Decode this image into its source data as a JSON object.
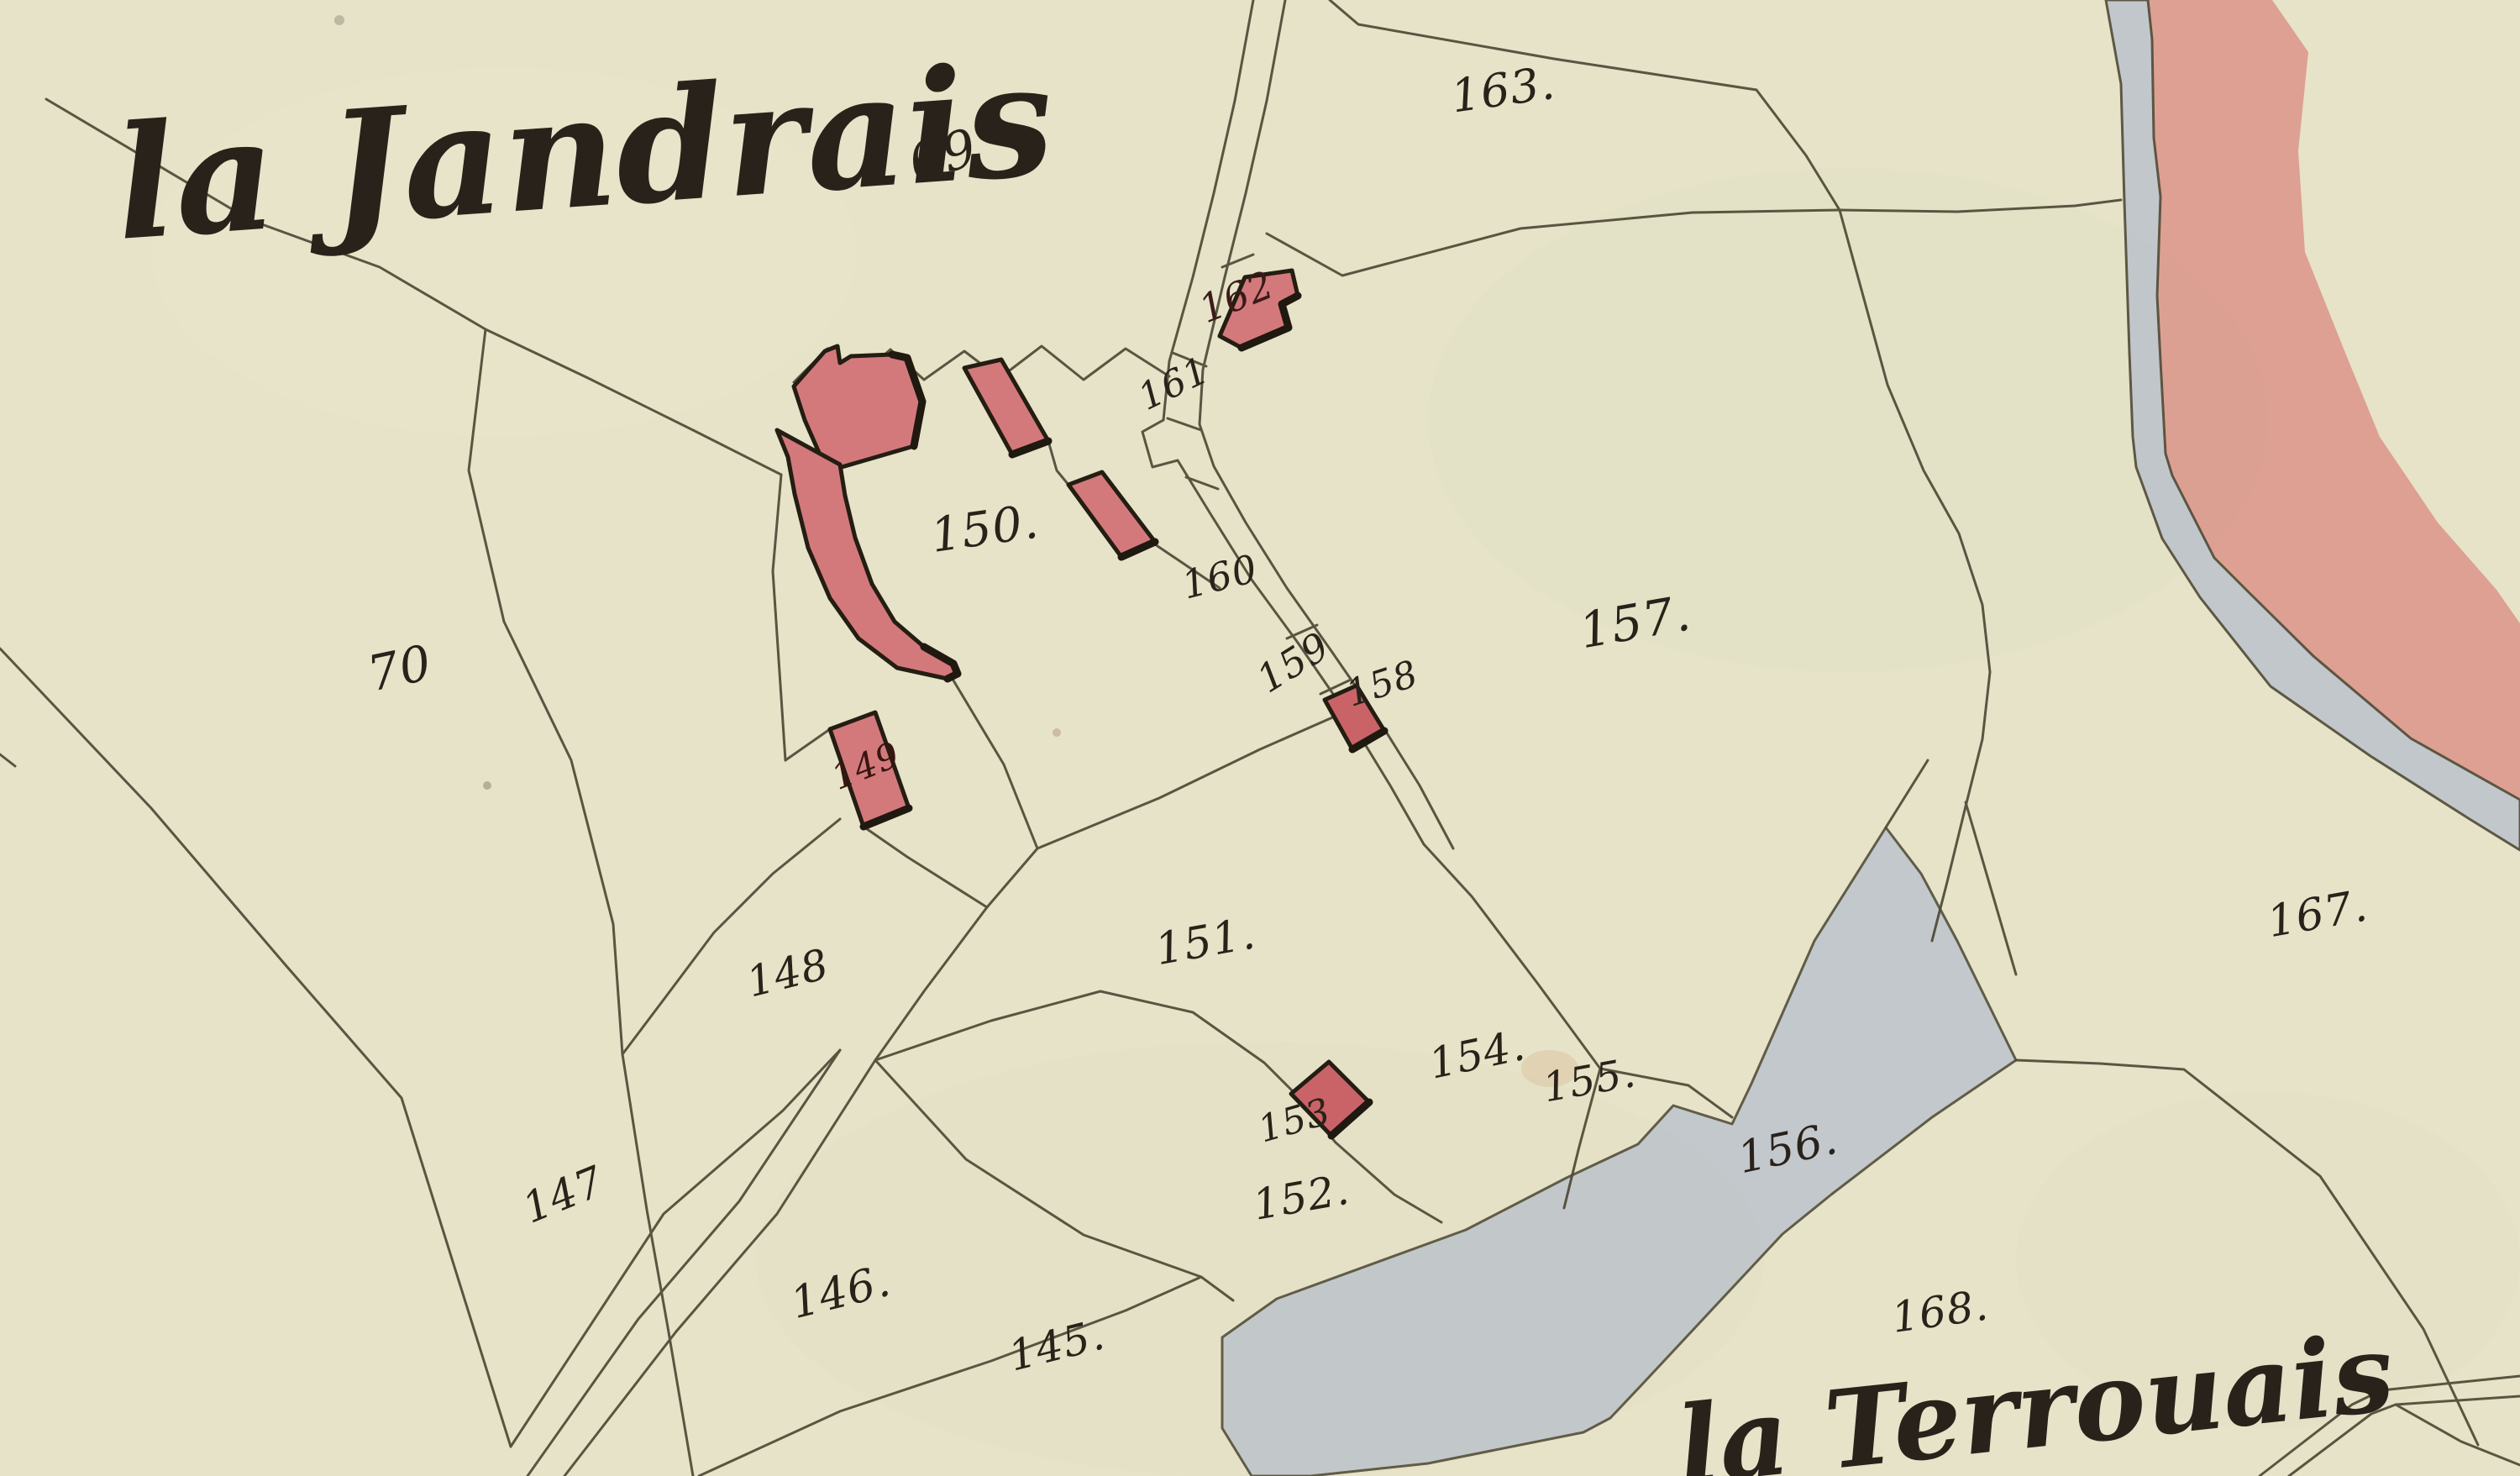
{
  "map": {
    "region_names": {
      "primary": "la Jandrais",
      "secondary": "la Terrouais"
    },
    "parcels": {
      "p69": "69",
      "p70": "70",
      "p145": "145.",
      "p146": "146.",
      "p147": "147",
      "p148": "148",
      "p149": "149",
      "p150": "150.",
      "p151": "151.",
      "p152": "152.",
      "p153": "153",
      "p154": "154.",
      "p155": "155.",
      "p156": "156.",
      "p157": "157.",
      "p158": "158",
      "p159": "159",
      "p160": "160",
      "p161": "161",
      "p162": "162",
      "p163": "163.",
      "p167": "167.",
      "p168": "168."
    },
    "colors": {
      "paper": "#e6e3c8",
      "paper_shade": "#dcd8b8",
      "ink": "#4e4936",
      "label_ink": "#29221a",
      "building": "#d3797c",
      "building_dark": "#ca6367",
      "building_outline": "#241d12",
      "water": "#bdc4cb",
      "road_wash": "#db9187",
      "stain": "#c8935f"
    }
  }
}
